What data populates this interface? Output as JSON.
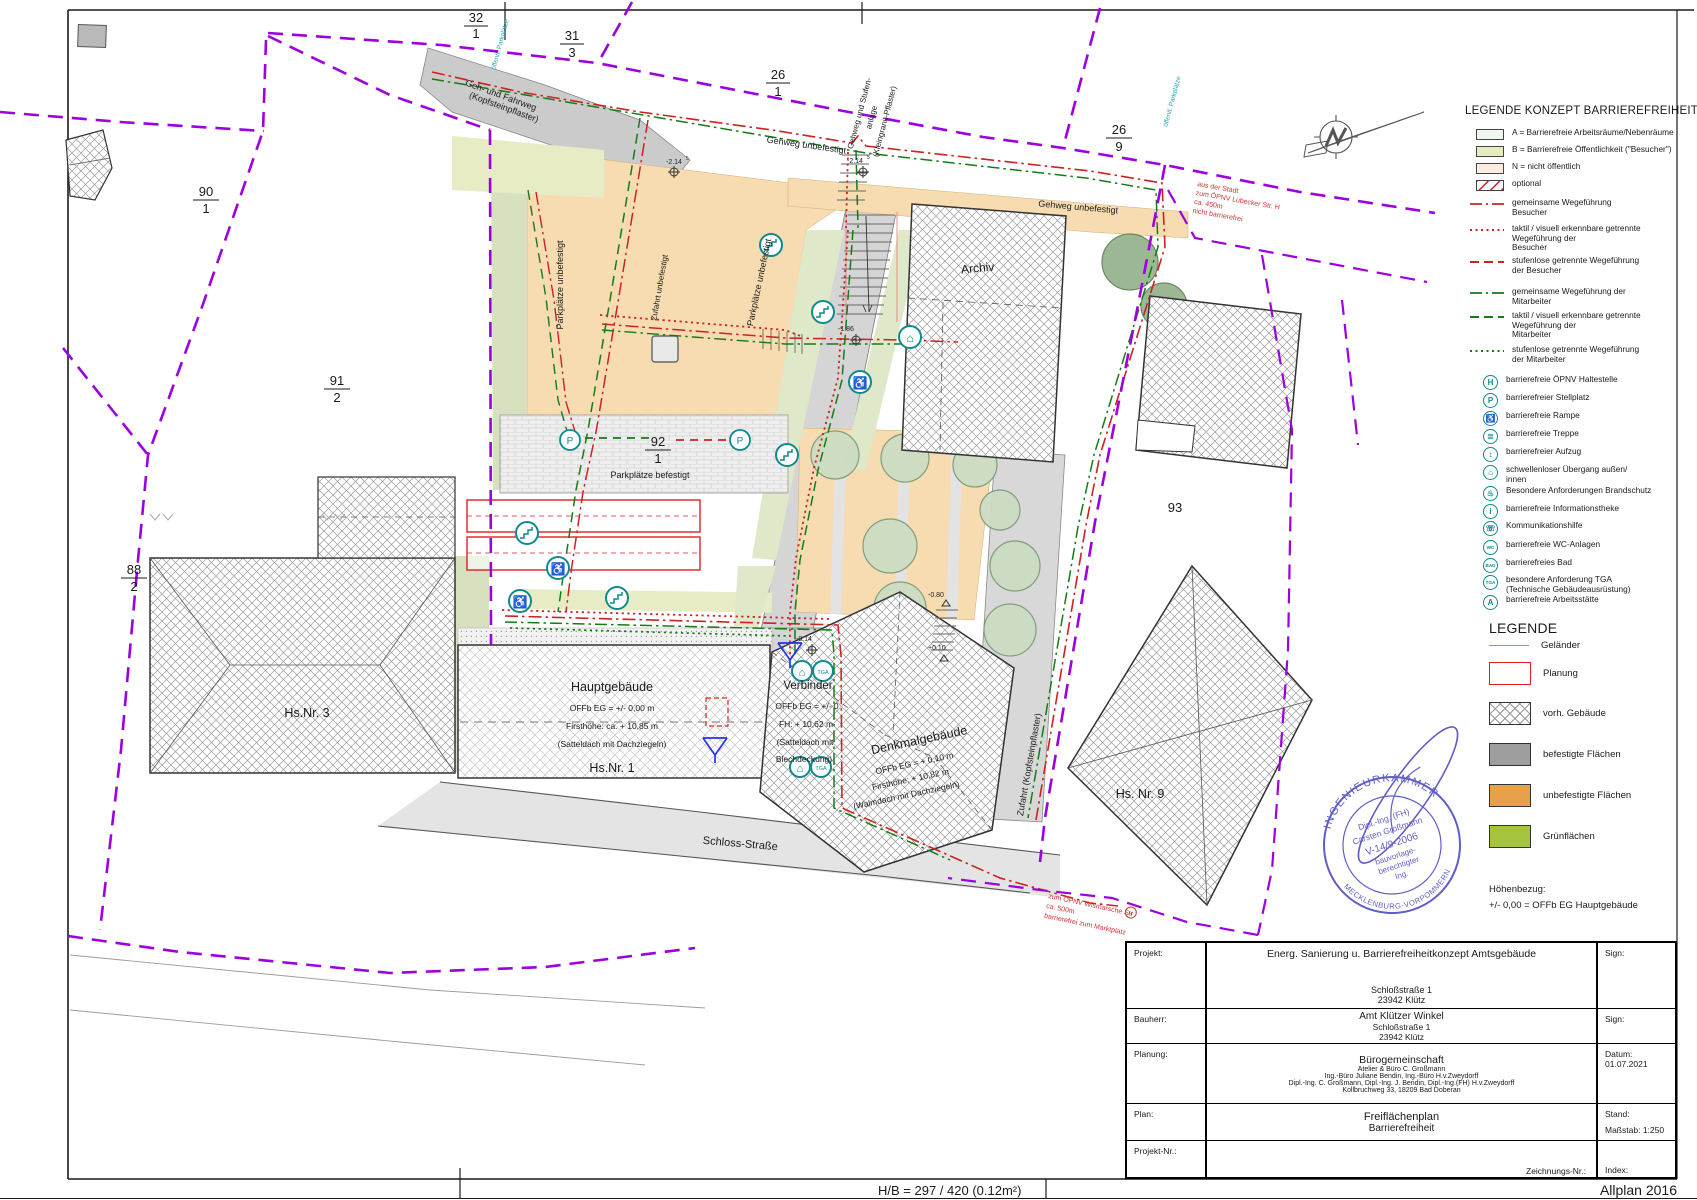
{
  "sheet": {
    "hb_note": "H/B = 297 / 420 (0.12m²)",
    "software": "Allplan 2016"
  },
  "legend_concept": {
    "title": "LEGENDE KONZEPT BARRIEREFREIHEIT",
    "area_items": [
      {
        "label": "A = Barrierefreie Arbeitsräume/Nebenräume"
      },
      {
        "label": "B = Barrierefreie Öffentlichkeit (\"Besucher\")"
      },
      {
        "label": "N = nicht öffentlich"
      },
      {
        "label": "optional"
      }
    ],
    "line_items": [
      {
        "label": "gemeinsame Wegeführung\nBesucher"
      },
      {
        "label": "taktil / visuell erkennbare getrennte\nWegeführung der\nBesucher"
      },
      {
        "label": "stufenlose getrennte Wegeführung\nder Besucher"
      },
      {
        "label": "gemeinsame Wegeführung der\nMitarbeiter"
      },
      {
        "label": "taktil / visuell erkennbare getrennte\nWegeführung der\nMitarbeiter"
      },
      {
        "label": "stufenlose getrennte Wegeführung\nder Mitarbeiter"
      }
    ],
    "icon_items": [
      {
        "char": "H",
        "label": "barrierefreie ÖPNV Haltestelle"
      },
      {
        "char": "P",
        "label": "barrierefreier Stellplatz"
      },
      {
        "char": "♿",
        "label": "barrierefreie Rampe"
      },
      {
        "char": "≣",
        "label": "barrierefreie Treppe"
      },
      {
        "char": "↕",
        "label": "barrierefreier Aufzug"
      },
      {
        "char": "⌂",
        "label": "schwellenloser Übergang außen/\ninnen"
      },
      {
        "char": "♨",
        "label": "Besondere Anforderungen Brandschutz"
      },
      {
        "char": "i",
        "label": "barrierefreie Informationstheke"
      },
      {
        "char": "☏",
        "label": "Kommunikationshilfe"
      },
      {
        "char": "WC",
        "label": "barrierefreie WC-Anlagen"
      },
      {
        "char": "BAD",
        "label": "barrierefreies Bad"
      },
      {
        "char": "TGA",
        "label": "besondere Anforderung TGA\n(Technische Gebäudeausrüstung)"
      },
      {
        "char": "A",
        "label": "barrierefreie Arbeitsstätte"
      }
    ]
  },
  "legend_surfaces": {
    "title": "LEGENDE",
    "items": [
      {
        "label": "Geländer"
      },
      {
        "label": "Planung"
      },
      {
        "label": "vorh. Gebäude"
      },
      {
        "label": "befestigte Flächen"
      },
      {
        "label": "unbefestigte Flächen"
      },
      {
        "label": "Grünflächen"
      }
    ],
    "hoehenbezug": "Höhenbezug:\n+/- 0,00 = OFFb EG Hauptgebäude"
  },
  "title_block": {
    "projekt_label": "Projekt:",
    "projekt_line1": "Energ. Sanierung u. Barrierefreiheitkonzept Amtsgebäude",
    "projekt_line2": "Schloßstraße 1",
    "projekt_line3": "23942 Klütz",
    "sign1_label": "Sign:",
    "bauherr_label": "Bauherr:",
    "bauherr_line1": "Amt Klützer Winkel",
    "bauherr_line2": "Schloßstraße 1",
    "bauherr_line3": "23942 Klütz",
    "sign2_label": "Sign:",
    "planung_label": "Planung:",
    "planung_line1": "Bürogemeinschaft",
    "planung_line2": "Atelier & Büro C. Großmann",
    "planung_line3": "Ing.-Büro Juliane Bendin, Ing.-Büro H.v.Zweydorff",
    "planung_line4": "Dipl.-Ing. C. Großmann, Dipl.-Ing. J. Bendin, Dipl.-Ing.(FH) H.v.Zweydorff",
    "planung_line5": "Kollbruchweg 33, 18209 Bad Doberan",
    "datum_label": "Datum:",
    "datum_value": "01.07.2021",
    "plan_label": "Plan:",
    "plan_line1": "Freiflächenplan",
    "plan_line2": "Barrierefreiheit",
    "stand_label": "Stand:",
    "massstab_label": "Maßstab:",
    "massstab_value": "1:250",
    "projektnr_label": "Projekt-Nr.:",
    "zeichnungsnr_label": "Zeichnungs-Nr.:",
    "index_label": "Index:"
  },
  "stamp": {
    "ring_top": "INGENIEURKAMMER",
    "ring_bottom": "MECKLENBURG-VORPOMMERN",
    "line1": "Dipl.-Ing. (FH)",
    "line2": "Carsten Großmann",
    "line3": "V-14/9-2006",
    "line4": "bauvorlage-",
    "line5": "berechtigter",
    "line6": "Ing."
  },
  "plan": {
    "parcels": {
      "p32n": "32",
      "p32d": "1",
      "p31n": "31",
      "p31d": "3",
      "p26an": "26",
      "p26ad": "1",
      "p26bn": "26",
      "p26bd": "9",
      "p90n": "90",
      "p90d": "1",
      "p91n": "91",
      "p91d": "2",
      "p88n": "88",
      "p88d": "2",
      "p92n": "92",
      "p92d": "1",
      "p93": "93"
    },
    "areas": {
      "geh_fahrweg": [
        "Geh- und Fahrweg",
        "(Kopfsteinpflaster)"
      ],
      "gehweg_unbefestigt": "Gehweg unbefestigt",
      "gehweg_stufen": [
        "Gehweg und Stufen-",
        "anlage",
        "(Kleingranit-Pflaster)"
      ],
      "parkplaetze_unbefestigt": "Parkplätze unbefestigt",
      "zufahrt_unbefestigt": "Zufahrt unbefestigt",
      "parkplaetze_befestigt": "Parkplätze befestigt",
      "zufahrt_kopfstein": "Zufahrt (Kopfsteinpflaster)",
      "oeffentl_parkplaetze": "öffentl. Parkplätze",
      "schloss_strasse": "Schloss-Straße",
      "archiv": "Archiv"
    },
    "buildings": {
      "haupt_name": "Hauptgebäude",
      "haupt_l1": "OFFb EG = +/- 0,00 m",
      "haupt_l2": "Firsthöhe: ca. + 10,85 m",
      "haupt_l3": "(Satteldach mit Dachziegeln)",
      "haupt_hs": "Hs.Nr. 1",
      "verb_name": "Verbinder",
      "verb_l1": "OFFb EG = +/- 0",
      "verb_l2": "FH: + 10,62 m",
      "verb_l3": "(Satteldach mit",
      "verb_l4": "Blechdeckung)",
      "denkmal_name": "Denkmalgebäude",
      "denkmal_l1": "OFFb EG = + 0,10 m",
      "denkmal_l2": "Firsthöhe: + 10,82 m",
      "denkmal_l3": "(Walmdach mit Dachziegeln)",
      "hs3": "Hs.Nr. 3",
      "hs9": "Hs. Nr. 9"
    },
    "annotations": {
      "north1": "aus der Stadt",
      "north2": "zum ÖPNV Lübecker Str.  H",
      "north3": "ca. 450m",
      "north4": "nicht barrierefrei",
      "south1": "zum ÖPNV Wismarsche Str",
      "south_h": "H",
      "south2": "ca. 500m",
      "south3": "barrierefrei zum Marktplatz"
    },
    "levels": {
      "a": "-2.14",
      "a_sup": "5",
      "b": "-2.14",
      "b_sup": "5",
      "c": "-1.86",
      "d": "-0.14",
      "e": "-0.80",
      "f": "+0.10"
    },
    "icon_chars": {
      "p": "P",
      "h": "H",
      "ramp": "♿",
      "door": "⌂",
      "tga": "TGA"
    }
  }
}
